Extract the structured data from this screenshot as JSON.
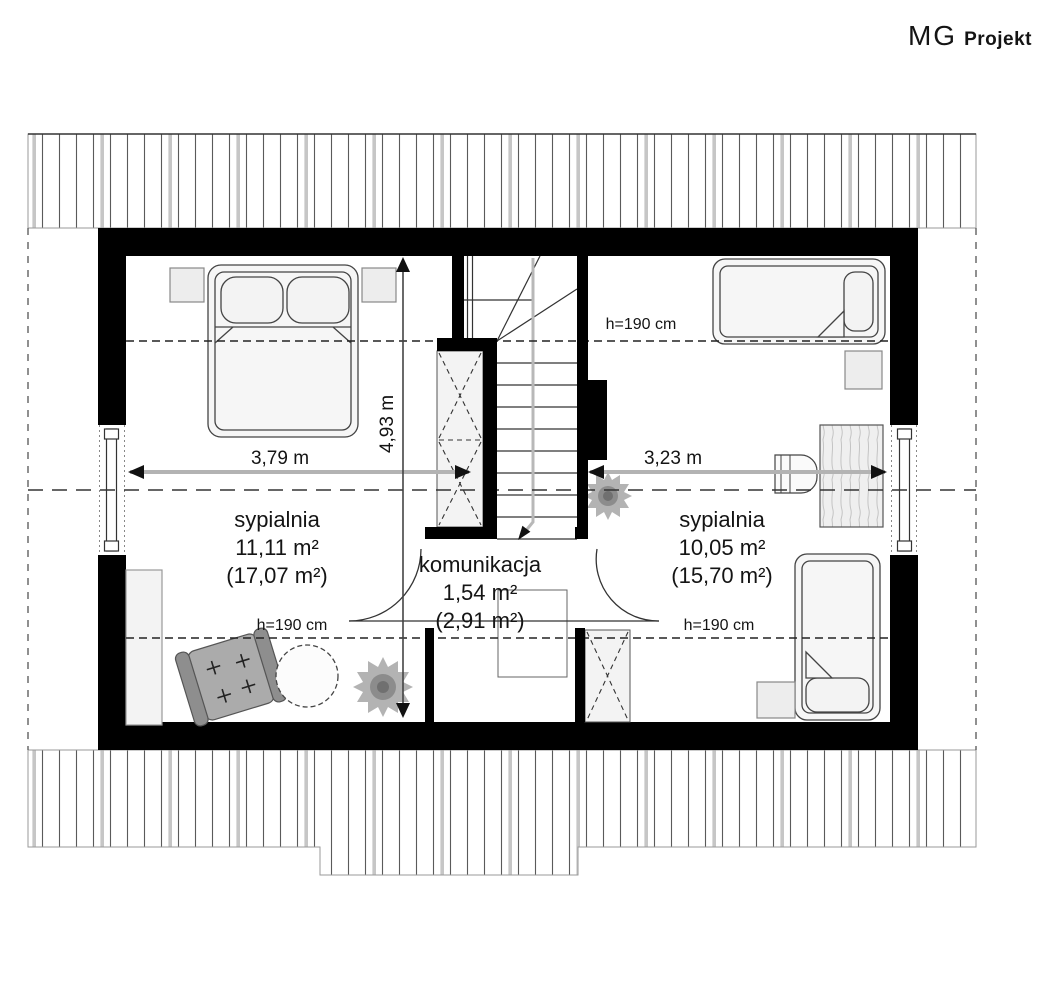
{
  "logo": {
    "brand": "MG",
    "suffix": "Projekt"
  },
  "plan": {
    "rooms": [
      {
        "id": "bedroom-left",
        "name": "sypialnia",
        "area": "11,11 m²",
        "floor_area": "(17,07 m²)"
      },
      {
        "id": "hall",
        "name": "komunikacja",
        "area": "1,54 m²",
        "floor_area": "(2,91 m²)"
      },
      {
        "id": "bedroom-right",
        "name": "sypialnia",
        "area": "10,05 m²",
        "floor_area": "(15,70 m²)"
      }
    ],
    "dimensions": {
      "bedroom_left_width": "3,79 m",
      "bedroom_right_width": "3,23 m",
      "depth": "4,93 m"
    },
    "height_labels": {
      "top": "h=190 cm",
      "bottom_left": "h=190 cm",
      "bottom_right": "h=190 cm"
    },
    "colors": {
      "wall": "#000000",
      "dimension_line": "#b3b3b3",
      "hatch_line": "#5a5a5a",
      "furniture_fill": "#f5f5f5",
      "accent_gray": "#a9a9a9"
    }
  }
}
